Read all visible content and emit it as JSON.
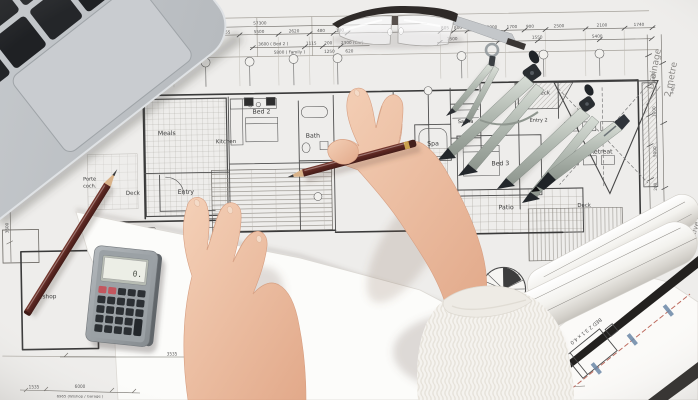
{
  "photo": {
    "notes": {
      "drainage_line1": "Drainage",
      "drainage_line2": "2 metre",
      "protective": "Protective P",
      "roll_label": "BED 2  3.1 x 4.0"
    },
    "rooms": {
      "meals": "Meals",
      "kitchen": "Kitchen",
      "bed2": "Bed 2",
      "bath": "Bath",
      "entry": "Entry",
      "deck_left": "Deck",
      "living": "Living",
      "wshop": "W/shop",
      "porte1": "Porte",
      "porte2": "coch.",
      "spa": "Spa",
      "sauna": "Sauna",
      "bed3": "Bed 3",
      "deck_topright": "Deck",
      "entry2": "Entry 2",
      "deck_mid": "Deck",
      "retreat": "Retreat",
      "patio": "Patio",
      "deck_bottomright": "Deck"
    },
    "dims": {
      "overall": "57300",
      "row1": [
        "1800",
        "3040",
        "1955",
        "5500",
        "2620",
        "480",
        "180"
      ],
      "row2": [
        "3600 ( Bed 2 )",
        "1115",
        "200",
        "2300 (Cnr)"
      ],
      "row3": [
        "5800 ( Family )",
        "1250",
        "620"
      ],
      "tr1": [
        "805",
        "800",
        "1225",
        "8000",
        "1700",
        "900",
        "2500",
        "2100",
        "1740"
      ],
      "tr2": [
        "1500",
        "7260",
        "1550",
        "5400"
      ],
      "bl1": "3535",
      "bl2": [
        "1535",
        "6000"
      ],
      "bl3": "6965 (W/shop / Garage )",
      "br1": "4400 (Bed 3)",
      "br2": [
        "1390",
        "1610"
      ],
      "right": [
        "3400",
        "1000",
        "5000",
        "200",
        "5403"
      ],
      "left": [
        "1800",
        "3600"
      ]
    },
    "calculator": {
      "lcd": "0."
    }
  }
}
